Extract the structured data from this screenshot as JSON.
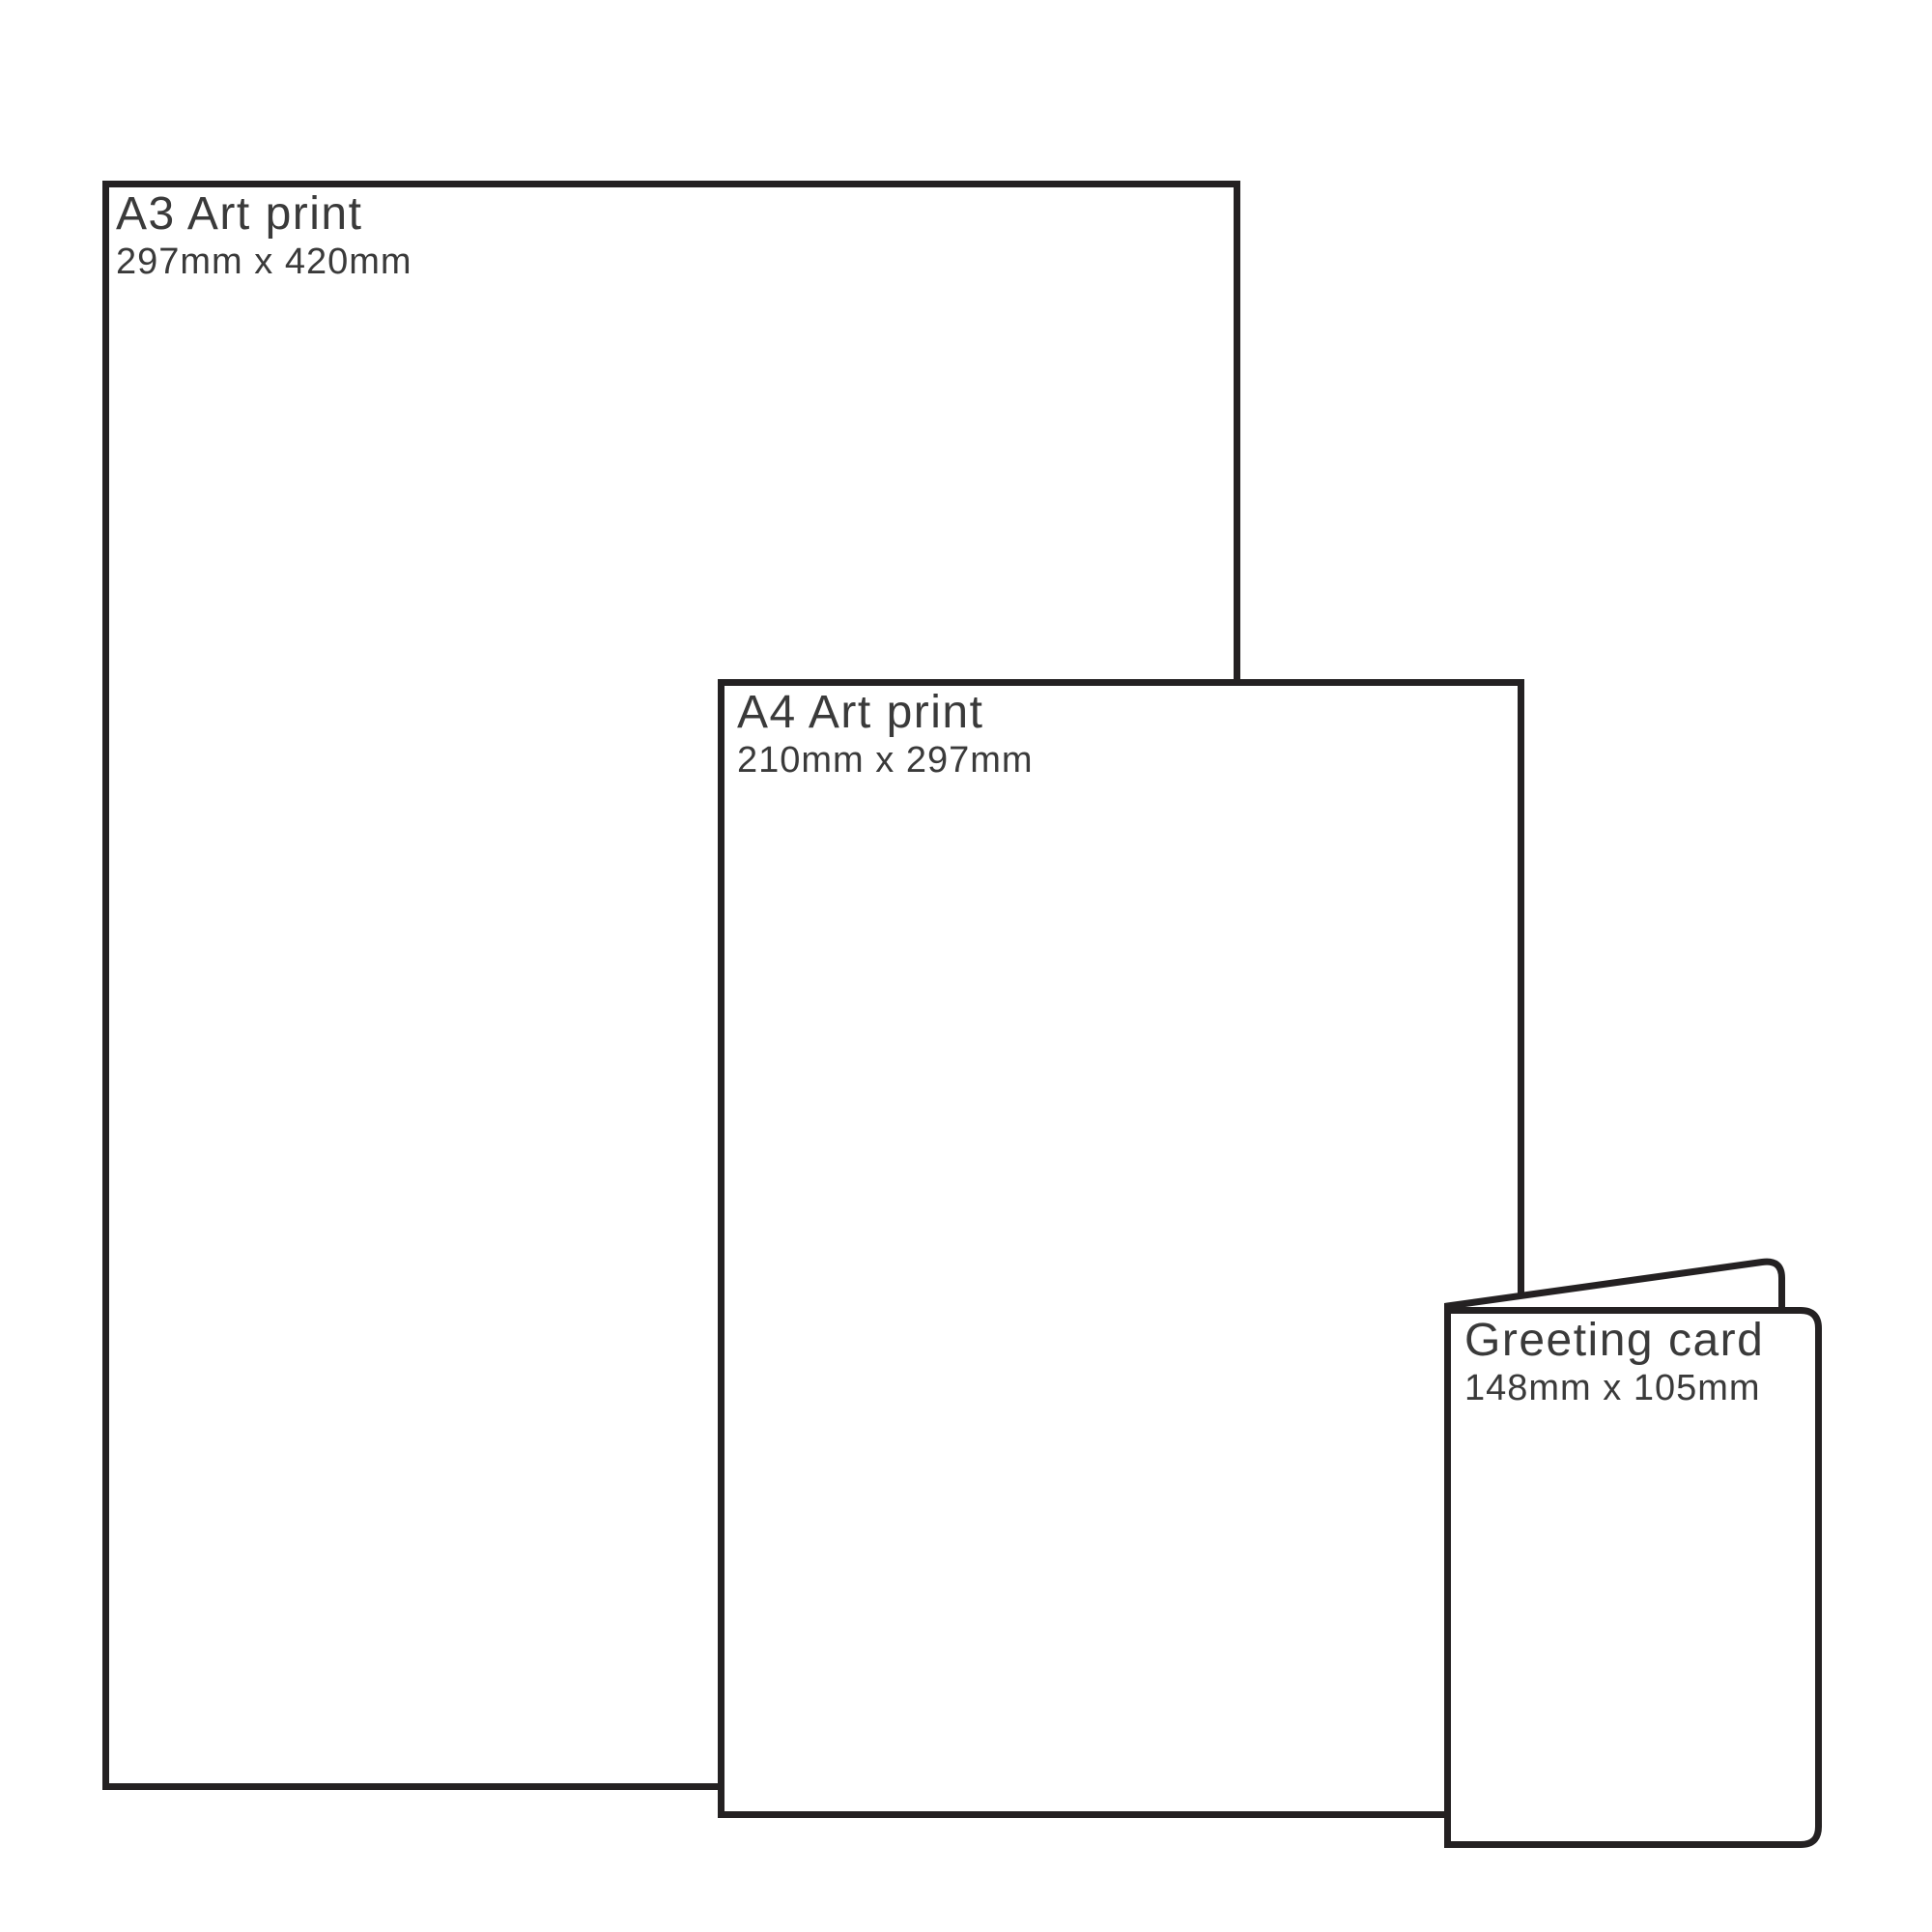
{
  "page": {
    "background_color": "#ffffff",
    "outline_color": "#242122",
    "label_color": "#3a3a3a"
  },
  "items": [
    {
      "id": "a3-art-print",
      "title": "A3 Art print",
      "dimensions": "297mm x 420mm"
    },
    {
      "id": "a4-art-print",
      "title": "A4 Art print",
      "dimensions": "210mm x 297mm"
    },
    {
      "id": "greeting-card",
      "title": "Greeting card",
      "dimensions": "148mm x 105mm"
    }
  ]
}
